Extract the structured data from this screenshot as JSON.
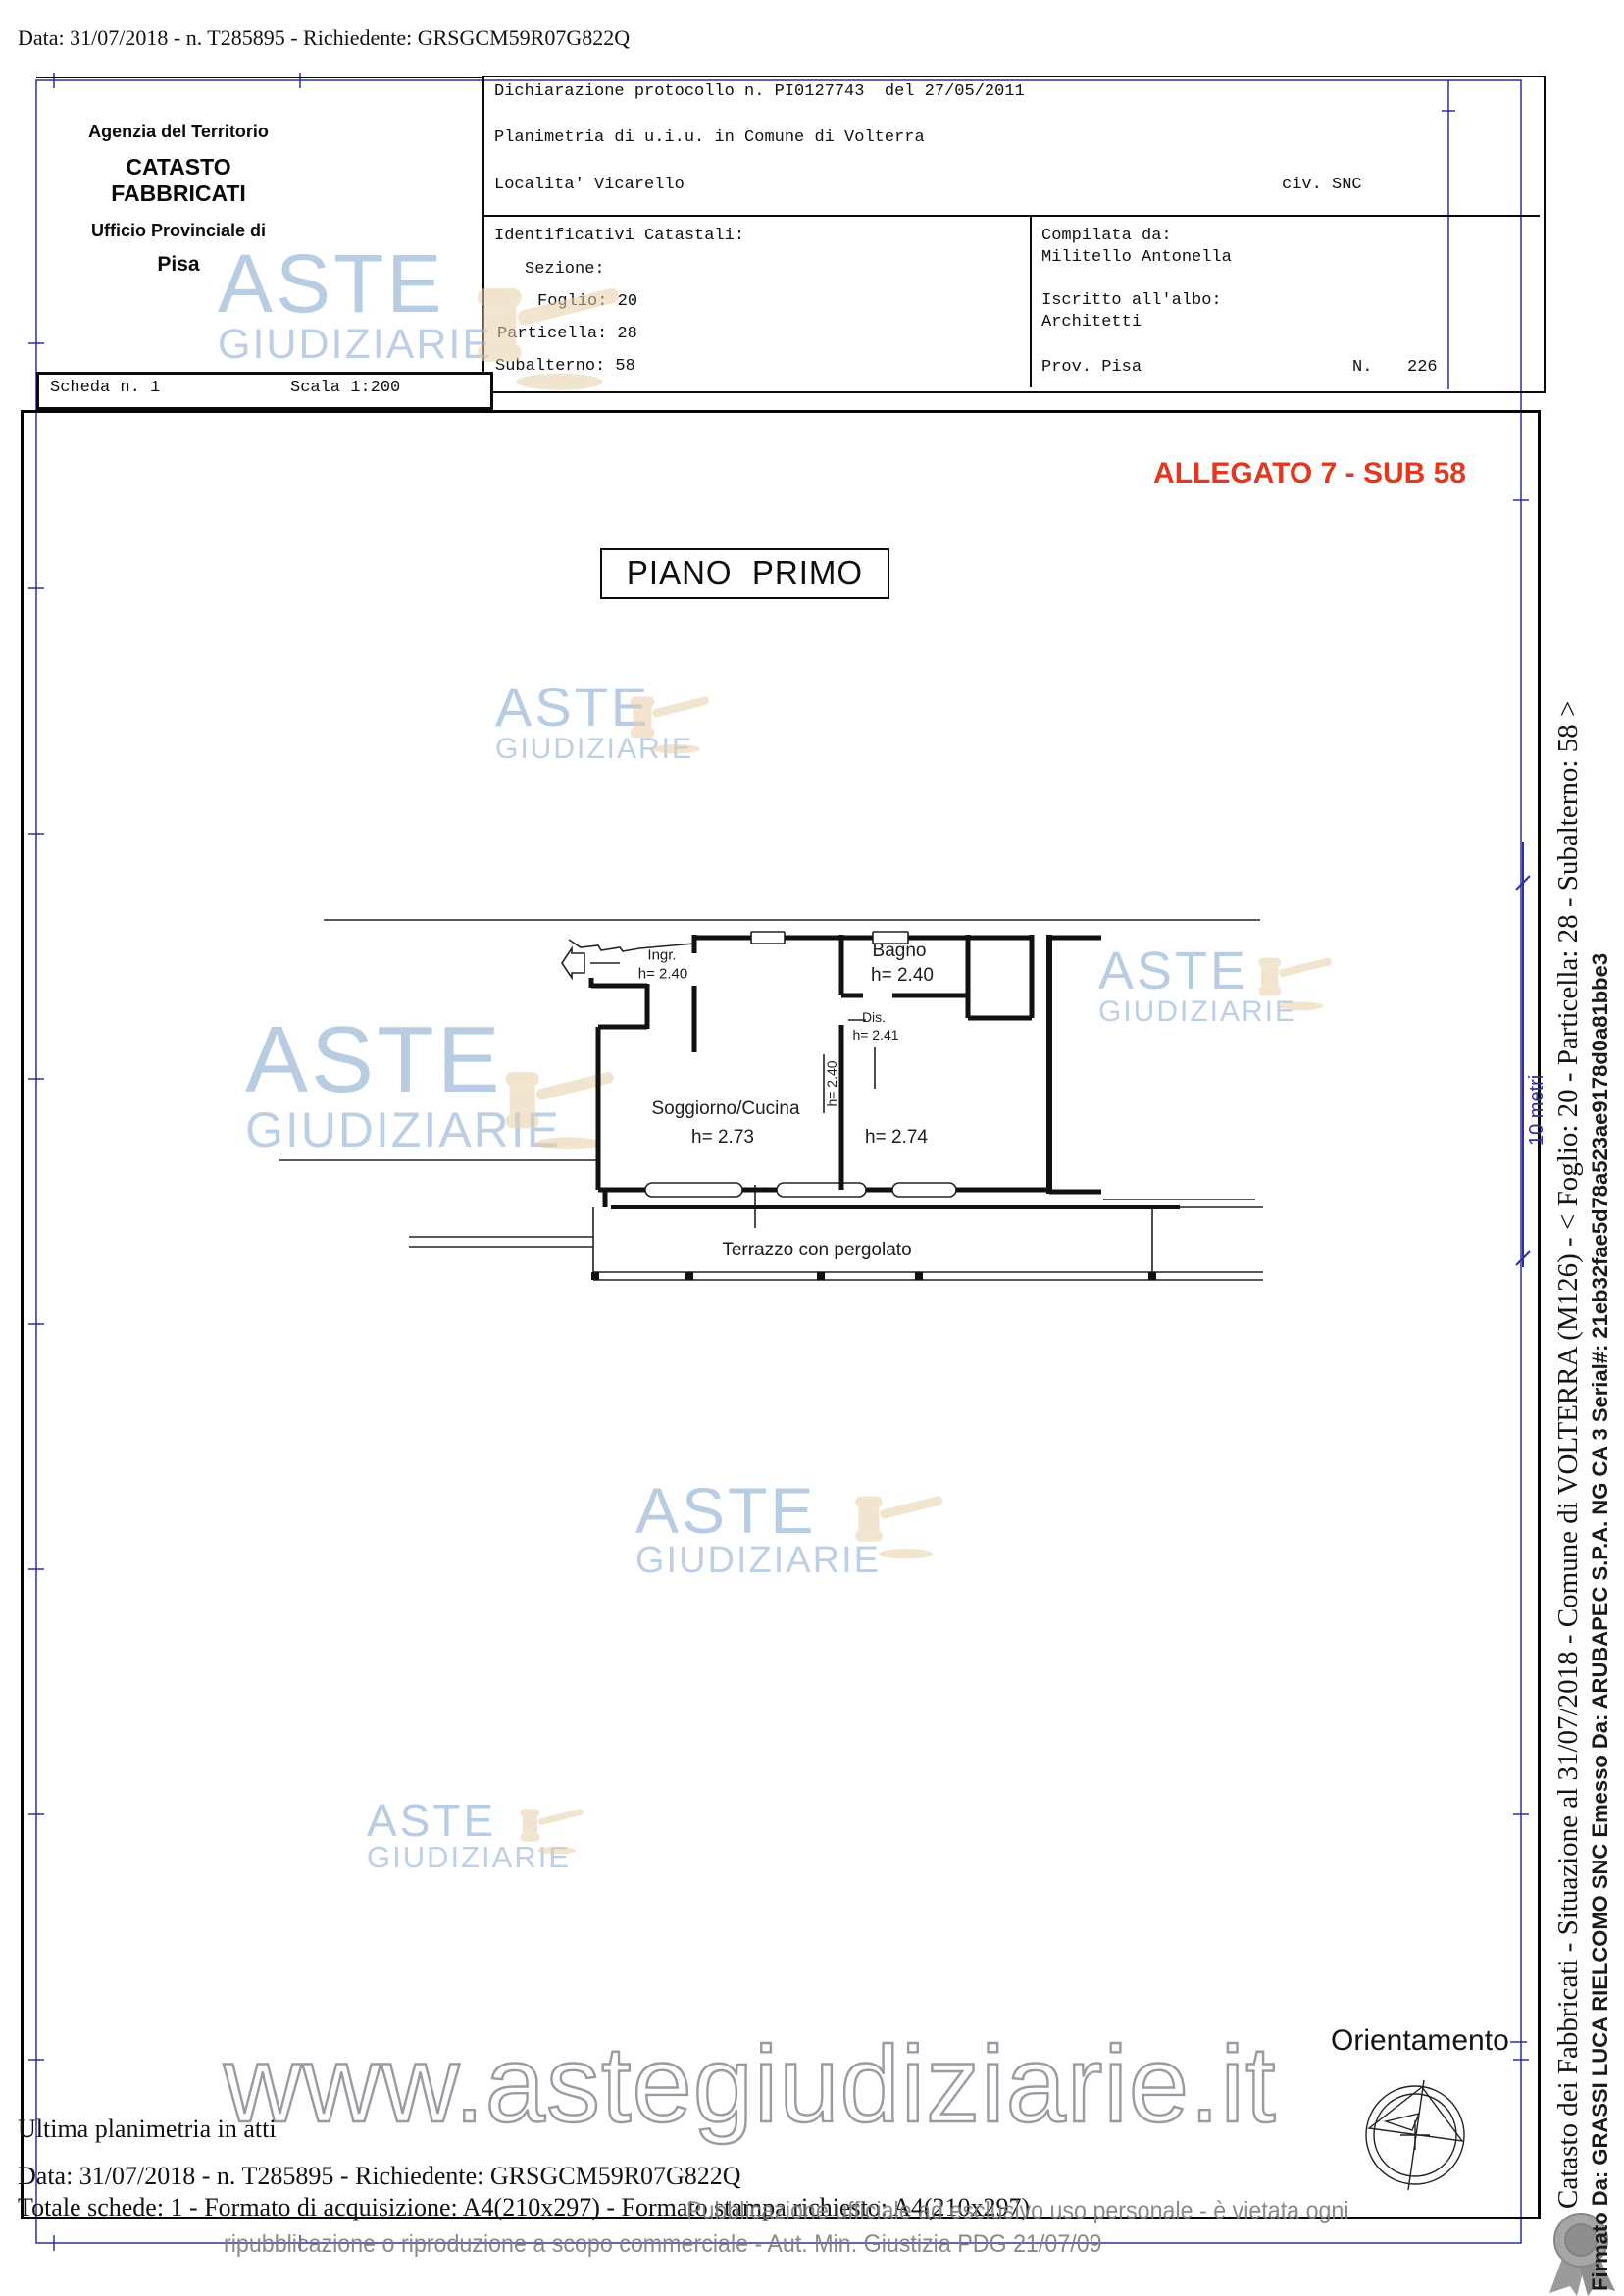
{
  "page": {
    "header_top": "Data: 31/07/2018 - n. T285895 - Richiedente: GRSGCM59R07G822Q"
  },
  "agency_box": {
    "line1": "Agenzia del Territorio",
    "line2": "CATASTO FABBRICATI",
    "line3": "Ufficio Provinciale di",
    "line4": "Pisa"
  },
  "declaration_box": {
    "protocol_line": "Dichiarazione protocollo n. PI0127743  del 27/05/2011",
    "planimetria_line": "Planimetria di u.i.u. in Comune di Volterra",
    "locality": "Localita' Vicarello",
    "civic": "civ. SNC",
    "identifiers_title": "Identificativi Catastali:",
    "sezione": "Sezione:",
    "foglio": "Foglio: 20",
    "particella": "Particella: 28",
    "subalterno": "Subalterno: 58",
    "compiled_by_label": "Compilata da:",
    "compiled_by_name": "Militello Antonella",
    "register_label": "Iscritto all'albo:",
    "register_value": "Architetti",
    "prov": "Prov. Pisa",
    "n_label": "N.",
    "n_value": "226"
  },
  "sheet_box": {
    "scheda": "Scheda n. 1",
    "scala": "Scala 1:200"
  },
  "allegato": "ALLEGATO 7 - SUB 58",
  "floor_title": "PIANO  PRIMO",
  "plan": {
    "labels": [
      {
        "id": "ingr-name",
        "text": "Ingr."
      },
      {
        "id": "ingr-height",
        "text": "h= 2.40"
      },
      {
        "id": "bagno-name",
        "text": "Bagno"
      },
      {
        "id": "bagno-height",
        "text": "h= 2.40"
      },
      {
        "id": "dis-name",
        "text": "Dis."
      },
      {
        "id": "dis-height",
        "text": "h= 2.41"
      },
      {
        "id": "hall-height",
        "text": "h= 2.40"
      },
      {
        "id": "soggiorno-name",
        "text": "Soggiorno/Cucina"
      },
      {
        "id": "soggiorno-height",
        "text": "h= 2.73"
      },
      {
        "id": "room-height",
        "text": "h= 2.74"
      },
      {
        "id": "terrazzo-name",
        "text": "Terrazzo con pergolato"
      }
    ],
    "scale_label": "10 metri"
  },
  "orientation": {
    "label": "Orientamento"
  },
  "watermark": {
    "line1": "ASTE",
    "line2": "GIUDIZIARIE",
    "url": "www.astegiudiziarie.it"
  },
  "footer": {
    "line1": "Ultima planimetria in atti",
    "line2": "Data: 31/07/2018 - n. T285895 - Richiedente: GRSGCM59R07G822Q",
    "line3": "Totale schede: 1 - Formato di acquisizione: A4(210x297) - Formato stampa richiesto: A4(210x297)",
    "gray1": "Pubblicazione ufficiale ad esclusivo uso personale - è vietata ogni",
    "gray2": "ripubblicazione o riproduzione a scopo commerciale - Aut. Min. Giustizia PDG 21/07/09"
  },
  "sidebar": {
    "catasto_line": "Catasto dei Fabbricati - Situazione al 31/07/2018 - Comune di VOLTERRA (M126) -  <  Foglio: 20 - Particella: 28 - Subalterno: 58 >",
    "signature_line": "Firmato Da: GRASSI LUCA RIELCOMO SNC Emesso Da: ARUBAPEC S.P.A. NG CA 3 Serial#: 21eb32fae5d78a523ae9178d0a81bbe3"
  },
  "colors": {
    "accent_red": "#e0391f",
    "frame_blue": "#2e2e9e",
    "watermark_blue": "#8dacd1",
    "gavel_tan": "#e6d0ab",
    "gray_text": "#7c7c7c"
  }
}
